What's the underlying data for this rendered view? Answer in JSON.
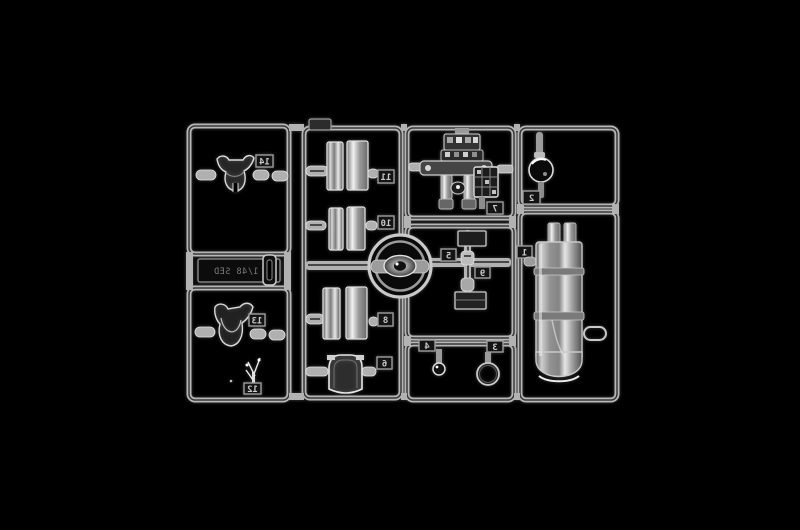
{
  "scene": {
    "type": "studio product photograph",
    "subject": "clear plastic model kit sprue with transparent parts",
    "background_color": "#000000",
    "plastic_highlight_color": "#d8d8d8",
    "rail_color": "#b6b6b6"
  },
  "sprue": {
    "embossed_plate": {
      "text": "1/48 SED",
      "mirrored": true
    },
    "top_tab": {
      "label": ""
    },
    "part_tags": [
      {
        "id": "tag-14",
        "number": "14",
        "part": "canopy upper-left"
      },
      {
        "id": "tag-13",
        "number": "13",
        "part": "canopy lower-left"
      },
      {
        "id": "tag-12",
        "number": "12",
        "part": "small antenna sprig"
      },
      {
        "id": "tag-11",
        "number": "11",
        "part": "clear half pair upper"
      },
      {
        "id": "tag-10",
        "number": "10",
        "part": "clear half pair middle"
      },
      {
        "id": "tag-8",
        "number": "8",
        "part": "clear half pair lower"
      },
      {
        "id": "tag-6",
        "number": "6",
        "part": "windscreen arch"
      },
      {
        "id": "tag-7",
        "number": "7",
        "part": "detailed instrument assembly"
      },
      {
        "id": "tag-5",
        "number": "5",
        "part": "small rectangular pane upper"
      },
      {
        "id": "tag-9",
        "number": "9",
        "part": "small capsule on runner"
      },
      {
        "id": "tag-4",
        "number": "4",
        "part": "tiny light ball"
      },
      {
        "id": "tag-3",
        "number": "3",
        "part": "clear disc ring"
      },
      {
        "id": "tag-2",
        "number": "2",
        "part": "round lens"
      },
      {
        "id": "tag-1",
        "number": "1",
        "part": "large clear cylinder"
      }
    ]
  }
}
